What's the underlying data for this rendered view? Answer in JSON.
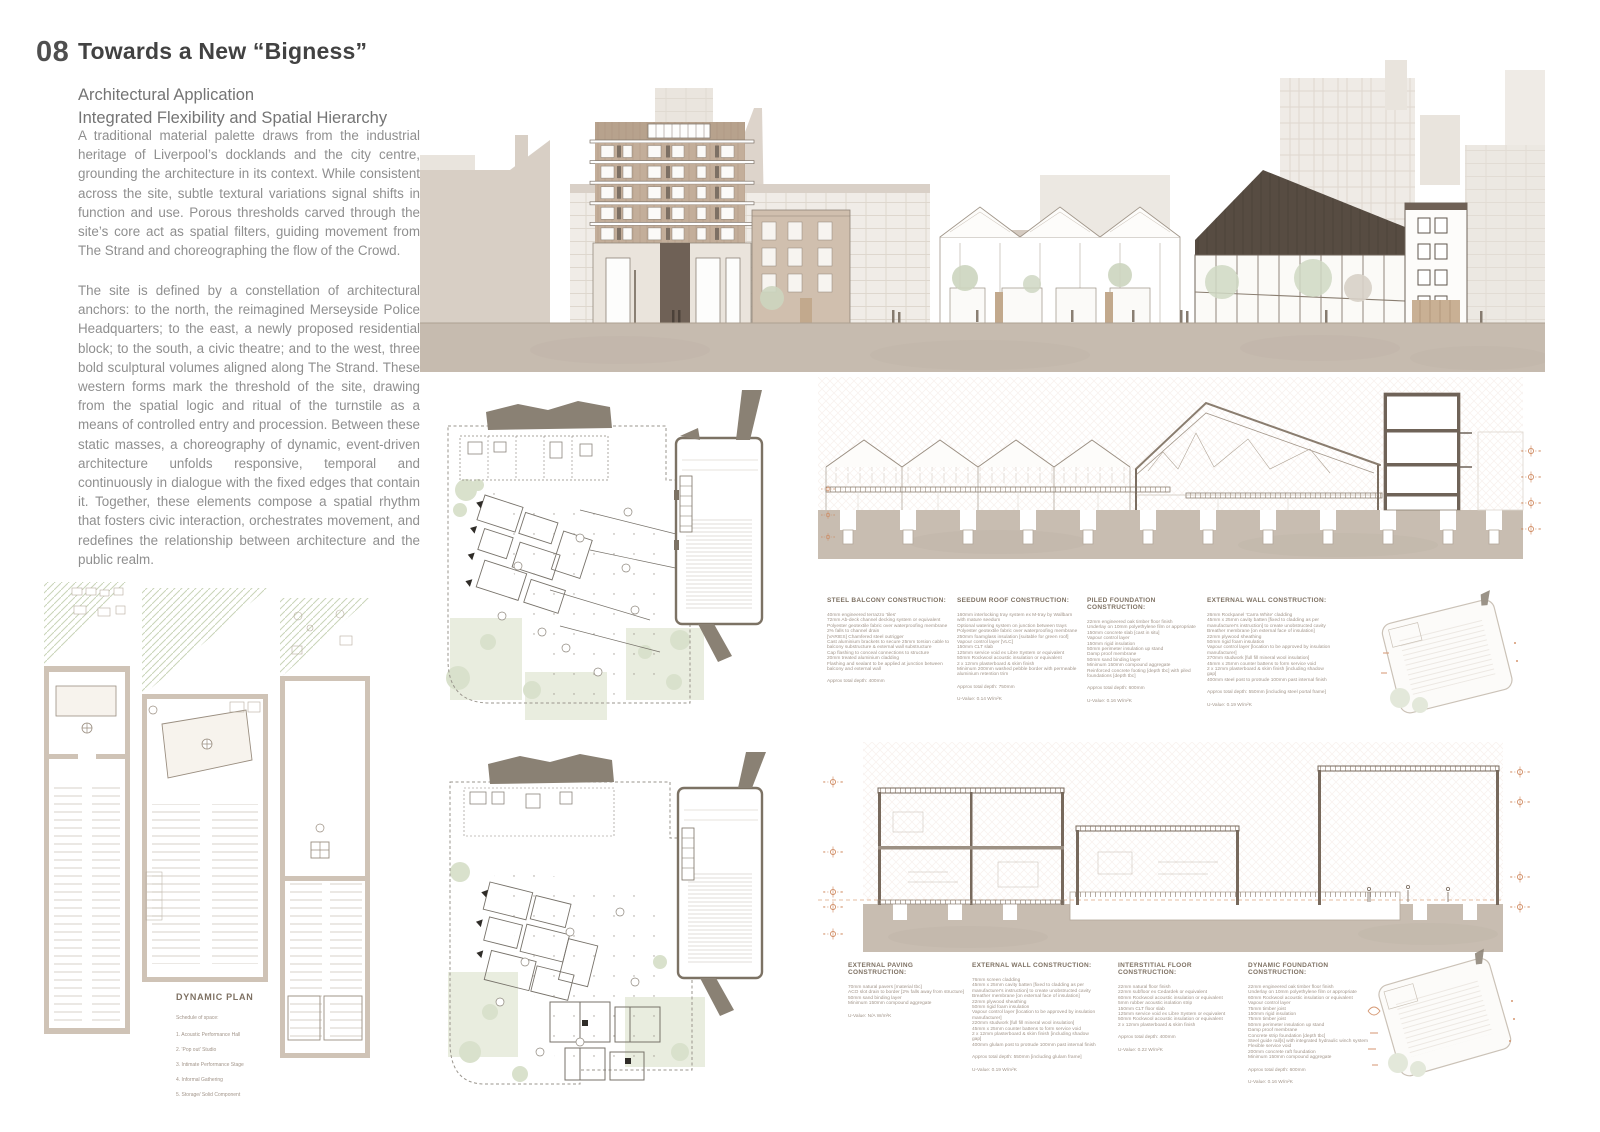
{
  "header": {
    "number": "08",
    "title": "Towards a New “Bigness”",
    "subtitle1": "Architectural Application",
    "subtitle2": "Integrated Flexibility and Spatial Hierarchy",
    "para1": "A traditional material palette draws from the industrial heritage of Liverpool’s docklands and the city centre, grounding the architecture in its context. While consistent across the site, subtle textural variations signal shifts in function and use. Porous thresholds carved through the site’s core act as spatial filters, guiding movement from The Strand and choreographing the flow of the Crowd.",
    "para2": "The site is defined by a constellation of architectural anchors: to the north, the reimagined Merseyside Police Headquarters; to the east, a newly proposed residential block; to the south, a civic theatre; and to the west, three bold sculptural volumes aligned along The Strand. These western forms mark the threshold of the site, drawing from the spatial logic and ritual of the turnstile as a means of controlled entry and procession. Between these static masses, a choreography of dynamic, event-driven architecture unfolds responsive, temporal and continuously in dialogue with the fixed edges that contain it. Together, these elements compose a spatial rhythm that fosters civic interaction, orchestrates movement, and redefines the relationship between architecture and the public realm.",
    "para3": ""
  },
  "specs_row1": [
    {
      "title": "STEEL BALCONY CONSTRUCTION:",
      "body": "40mm engineered terrazzo 'tiles'\n72mm Ab-deck channel decking system or equivalent\nPolyester geotextile fabric over waterproofing membrane\n2% falls to channel drain\n[VARIES] Chamfered steel outrigger\nCast aluminium brackets to secure 25mm torsion cable to balcony substructure & external wall substructure\nCap flashing to conceal connections to structure\n20mm treated aluminium cladding\nFlashing and sealant to be applied at junction between balcony and external wall",
      "total": "Approx total depth: 400mm",
      "uvalue": ""
    },
    {
      "title": "SEEDUM ROOF CONSTRUCTION:",
      "body": "160mm interlocking tray system ex M-tray by Wallbarn with mature seedum\nOptional watering system on junction between trays\nPolyester geotextile fabric over waterproofing membrane\n250mm foamglass insulation [suitable for green roof]\nVapour control layer [VLC]\n150mm CLT slab\n125mm service void ex Libre System or equivalent\n50mm Rockwool acoustic insulation or equivalent\n2 x 12mm plasterboard & skim finish\nMinimum 200mm washed pebble border with permeable aluminium retention trim",
      "total": "Approx total depth: 750mm",
      "uvalue": "U-Value: 0.14 W/m²K"
    },
    {
      "title": "PILED FOUNDATION CONSTRUCTION:",
      "body": "22mm engineered oak timber floor finish\nUnderlay on 10mm polyethylene film or appropriate\n150mm concrete slab [cast in situ]\nVapour control layer\n150mm rigid insulation\n50mm perimeter insulation up stand\nDamp proof membrane\n50mm sand binding layer\nMinimum 150mm compound aggregate\nReinforced concrete footing [depth tbc] with piled foundations [depth tbc]",
      "total": "Approx total depth: 600mm",
      "uvalue": "U-Value: 0.16 W/m²K"
    },
    {
      "title": "EXTERNAL WALL CONSTRUCTION:",
      "body": "26mm Rockpanel 'Carra White' cladding\n45mm x 25mm cavity batten [fixed to cladding as per manufacturer's instruction] to create unobstructed cavity\nBreather membrane [on external face of insulation]\n22mm plywood sheathing\n50mm rigid foam insulation\nVapour control layer [location to be approved by insulation manufacturer]\n270mm studwork [full fill mineral wool insulation]\n45mm x 25mm counter battens to form service void\n2 x 12mm plasterboard & skim finish [including shadow gap]\n400mm steel post to protrude 100mm past internal finish",
      "total": "Approx total depth: 550mm [including steel portal frame]",
      "uvalue": "U-Value: 0.19 W/m²K"
    }
  ],
  "specs_row2": [
    {
      "title": "EXTERNAL PAVING CONSTRUCTION:",
      "body": "70mm natural pavers [material tbc]\nACO slot drain to border [2% falls away from structure]\n50mm sand binding layer\nMinimum 150mm compound aggregate",
      "total": "",
      "uvalue": "U-Value: N/A W/m²K"
    },
    {
      "title": "EXTERNAL WALL CONSTRUCTION:",
      "body": "76mm screen cladding\n45mm x 25mm cavity batten [fixed to cladding as per manufacturer's instruction] to create unobstructed cavity\nBreather membrane [on external face of insulation]\n22mm plywood sheathing\n50mm rigid foam insulation\nVapour control layer [location to be approved by insulation manufacturer]\n220mm studwork [full fill mineral wool insulation]\n45mm x 25mm counter battens to form service void\n2 x 12mm plasterboard & skim finish [including shadow gap]\n400mm glulam post to protrude 100mm past internal finish",
      "total": "Approx total depth: 550mm [including glulam frame]",
      "uvalue": "U-Value: 0.19 W/m²K"
    },
    {
      "title": "INTERSTITIAL FLOOR CONSTRUCTION:",
      "body": "22mm natural floor finish\n22mm subfloor ex Cedardek or equivalent\n60mm Rockwool acoustic insulation or equivalent\n5mm rubber acoustic isolation strip\n150mm CLT floor slab\n125mm service void ex Libre System or equivalent\n50mm Rockwool acoustic insulation or equivalent\n2 x 12mm plasterboard & skim finish",
      "total": "Approx total depth: 400mm",
      "uvalue": "U-Value: 0.22 W/m²K"
    },
    {
      "title": "DYNAMIC FOUNDATION CONSTRUCTION:",
      "body": "22mm engineered oak timber floor finish\nUnderlay on 10mm polyethylene film or appropriate\n60mm Rockwool acoustic insulation or equivalent\nVapour control layer\n75mm timber joist\n150mm rigid insulation\n75mm timber joist\n50mm perimeter insulation up stand\nDamp proof membrane\nConcrete strip foundation [depth tbc]\nSteel guide rail[s] with integrated hydraulic winch system\nFlexible service void\n200mm concrete raft foundation\nMinimum 150mm compound aggregate",
      "total": "Approx total depth: 600mm",
      "uvalue": "U-Value: 0.16 W/m²K"
    }
  ],
  "dynamic_plan": {
    "title": "DYNAMIC PLAN",
    "subtitle": "Schedule of space:",
    "items": [
      "1. Acoustic Performance Hall",
      "2. 'Pop out' Studio",
      "3. Intimate Performance Stage",
      "4. Informal Gathering",
      "5. Storage/ Solid Component"
    ]
  },
  "colors": {
    "accent_orange": "#cd8458",
    "ground_taupe": "#c6bbaf",
    "dark_roof": "#574c42",
    "sage_green": "#d9e1cc",
    "body_text": "#8f8f8f",
    "spec_text": "#a2958a",
    "heading": "#454545"
  }
}
